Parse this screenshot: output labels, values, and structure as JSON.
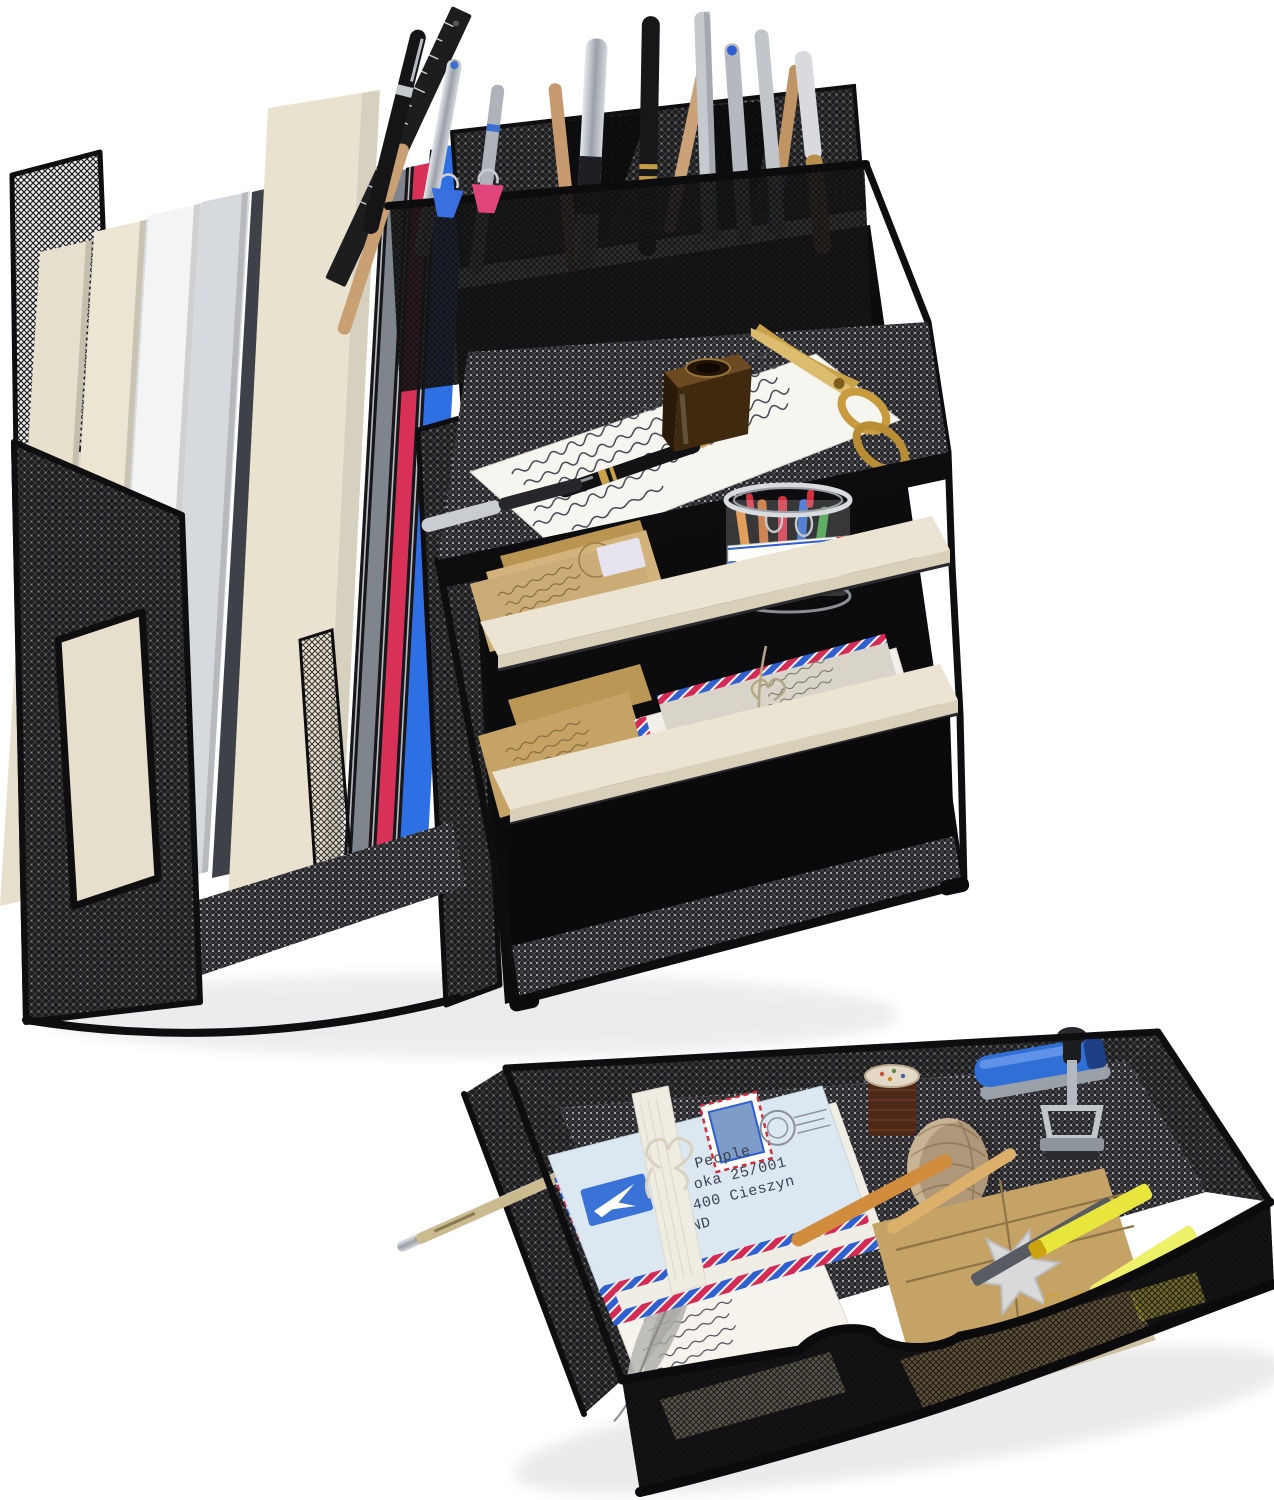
{
  "meta": {
    "type": "product-photo",
    "alt": "Black metal mesh desktop organizer set: vertical file rack with folders, pen holder, letter trays, and a separate mesh drawer tray filled with stationery",
    "background": "#ffffff"
  },
  "palette": {
    "frame": "#0e0e10",
    "mesh_dark": "#1d1d20",
    "shelf_board": "#ece4d2",
    "shelf_board_edge": "#d9d0ba",
    "kraft": "#c5a266",
    "kraft_dark": "#b3924f",
    "paper": "#f6f5f0",
    "gold": "#c79b3e",
    "amber_glass": "#3f2a10",
    "feather_gray": "#b9b8b4",
    "twine": "#c9b395",
    "thread_brown": "#4e2818",
    "star_silver": "#d9d9d9",
    "highlighter_yellow": "#e8e63c",
    "wood_stick": "#d28c3e"
  },
  "organizer": {
    "name": "mesh desk organizer",
    "folders": [
      {
        "name": "folder-cream-1",
        "color": "#e6dfcb"
      },
      {
        "name": "folder-cream-2",
        "color": "#ece5d2"
      },
      {
        "name": "folder-white",
        "color": "#f2f4f6"
      },
      {
        "name": "folder-silver",
        "color": "#d6d9dd"
      },
      {
        "name": "folder-charcoal",
        "color": "#3e4248"
      },
      {
        "name": "folder-cream-tall",
        "color": "#e9e2cf"
      },
      {
        "name": "folder-gray",
        "color": "#7e858d"
      },
      {
        "name": "folder-red",
        "color": "#d93058"
      },
      {
        "name": "folder-blue",
        "color": "#2f6fe4"
      }
    ],
    "binder_clips": [
      {
        "name": "binder-clip-blue",
        "color": "#3a6fe0"
      },
      {
        "name": "binder-clip-pink",
        "color": "#e0447a"
      }
    ],
    "pen_cup_items": [
      "black ruler",
      "wooden craft sticks",
      "ballpoint pens",
      "mechanical pencils",
      "fountain pens"
    ],
    "top_tray_items": [
      "handwritten letter",
      "black fountain pen",
      "chrome fountain pen",
      "amber glass ink bottle",
      "gold scissors"
    ],
    "shelf2_items": [
      "kraft envelopes",
      "paper clips jar"
    ],
    "jar": {
      "label": "PAPER CLIPS"
    },
    "shelf3_items": [
      "kraft envelopes",
      "airmail envelope bundle tied with twine"
    ],
    "drawer_bay": "empty slot for mesh drawer"
  },
  "drawer": {
    "name": "mesh drawer tray",
    "items": [
      "airmail envelope bundle",
      "white ribbon bow",
      "postage stamp",
      "thread spool",
      "twine ball",
      "blue stapler",
      "metal date stamper",
      "gray feather",
      "handwritten letter",
      "kraft notebook",
      "silver star ornament",
      "wooden sticks",
      "yellow highlighters",
      "gold paper clips",
      "metal pens"
    ],
    "envelope": {
      "address_lines": [
        "People",
        "oka 25/001",
        "400 Cieszyn",
        "ND"
      ]
    },
    "stapler_color": "#2f6fd6",
    "airmail": {
      "red": "#d42a55",
      "blue": "#2f5fd0"
    }
  }
}
